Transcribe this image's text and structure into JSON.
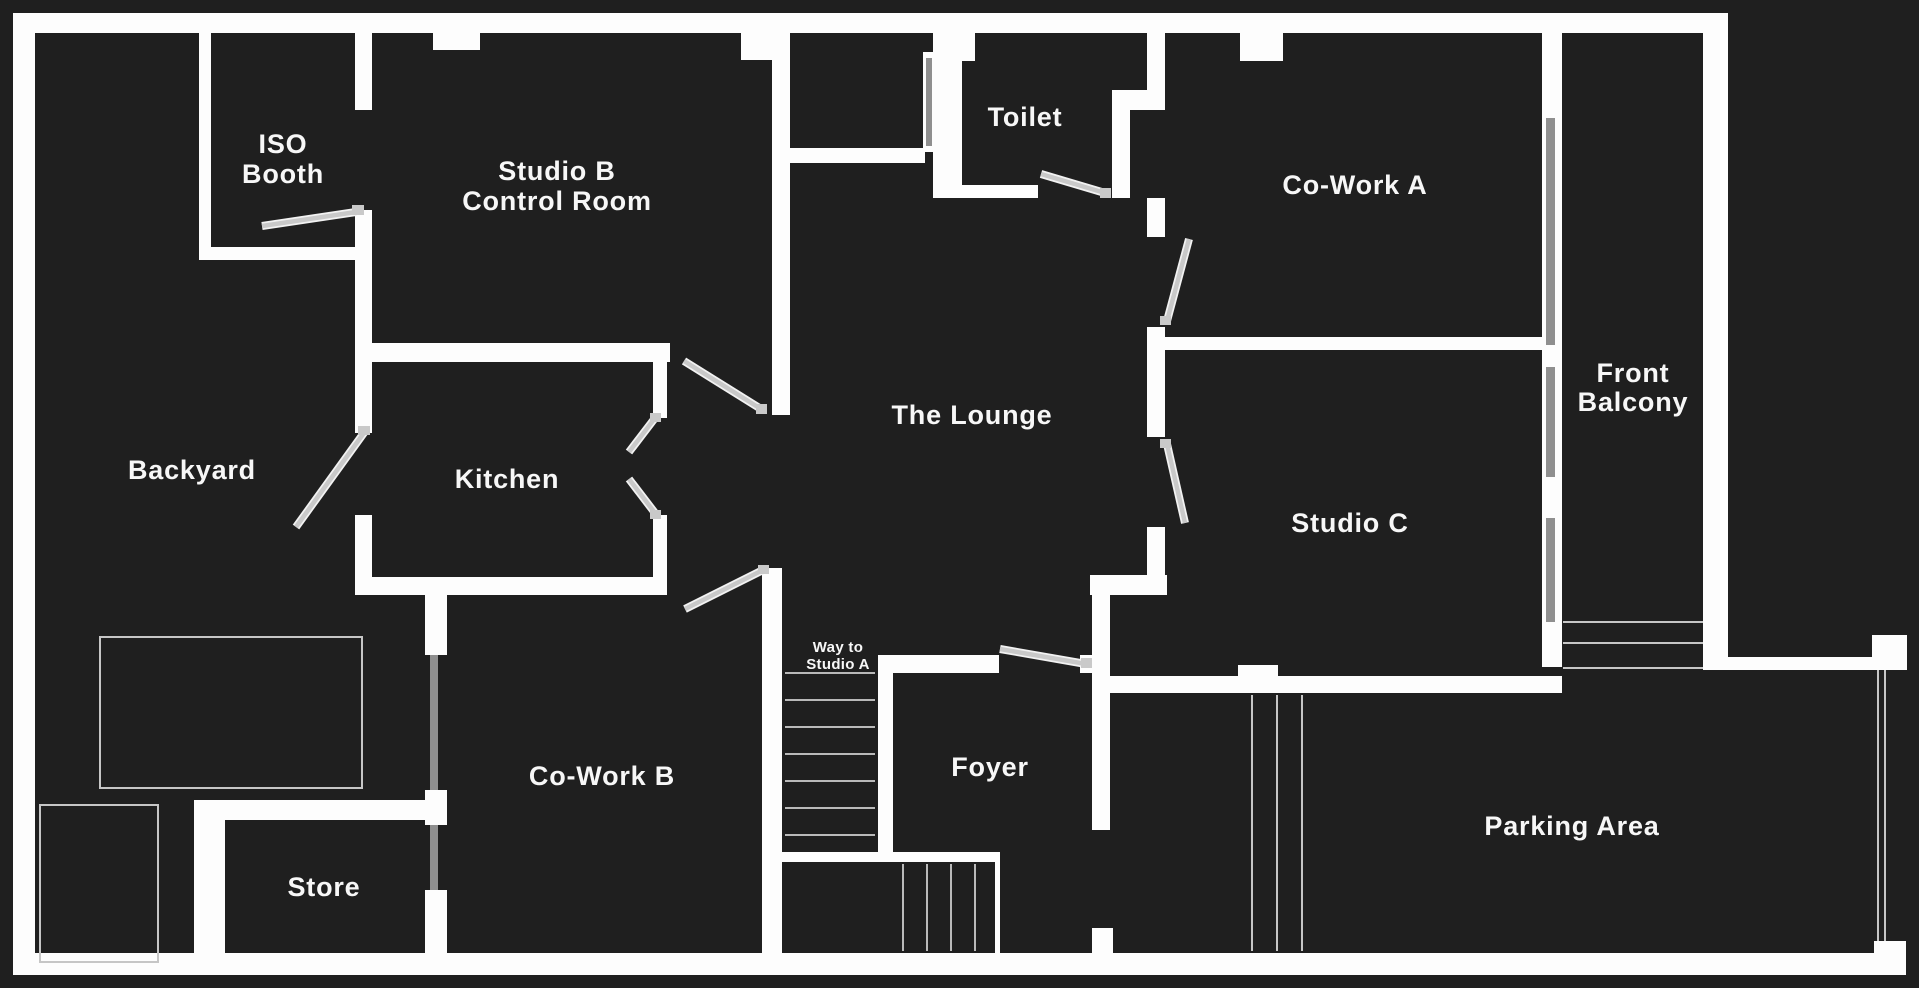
{
  "title": "Studio floor plan",
  "colors": {
    "background": "#1f1f1f",
    "wall": "#fdfdfd",
    "door": "#c9c9c9",
    "window": "#8f8f8f",
    "thin_line": "#c6c6c6",
    "label_text": "#f7f7f7"
  },
  "rooms": [
    {
      "id": "iso-booth",
      "label": "ISO Booth",
      "lines": [
        "ISO",
        "Booth"
      ]
    },
    {
      "id": "studio-b-cr",
      "label": "Studio B Control Room",
      "lines": [
        "Studio B",
        "Control Room"
      ]
    },
    {
      "id": "toilet",
      "label": "Toilet",
      "lines": [
        "Toilet"
      ]
    },
    {
      "id": "co-work-a",
      "label": "Co-Work A",
      "lines": [
        "Co-Work A"
      ]
    },
    {
      "id": "front-balcony",
      "label": "Front Balcony",
      "lines": [
        "Front",
        "Balcony"
      ]
    },
    {
      "id": "backyard",
      "label": "Backyard",
      "lines": [
        "Backyard"
      ]
    },
    {
      "id": "kitchen",
      "label": "Kitchen",
      "lines": [
        "Kitchen"
      ]
    },
    {
      "id": "the-lounge",
      "label": "The Lounge",
      "lines": [
        "The Lounge"
      ]
    },
    {
      "id": "studio-c",
      "label": "Studio C",
      "lines": [
        "Studio C"
      ]
    },
    {
      "id": "co-work-b",
      "label": "Co-Work B",
      "lines": [
        "Co-Work B"
      ]
    },
    {
      "id": "store",
      "label": "Store",
      "lines": [
        "Store"
      ]
    },
    {
      "id": "foyer",
      "label": "Foyer",
      "lines": [
        "Foyer"
      ]
    },
    {
      "id": "parking-area",
      "label": "Parking Area",
      "lines": [
        "Parking Area"
      ]
    },
    {
      "id": "way-to-studio-a",
      "label": "Way to Studio A",
      "lines": [
        "Way to",
        "Studio A"
      ]
    }
  ]
}
